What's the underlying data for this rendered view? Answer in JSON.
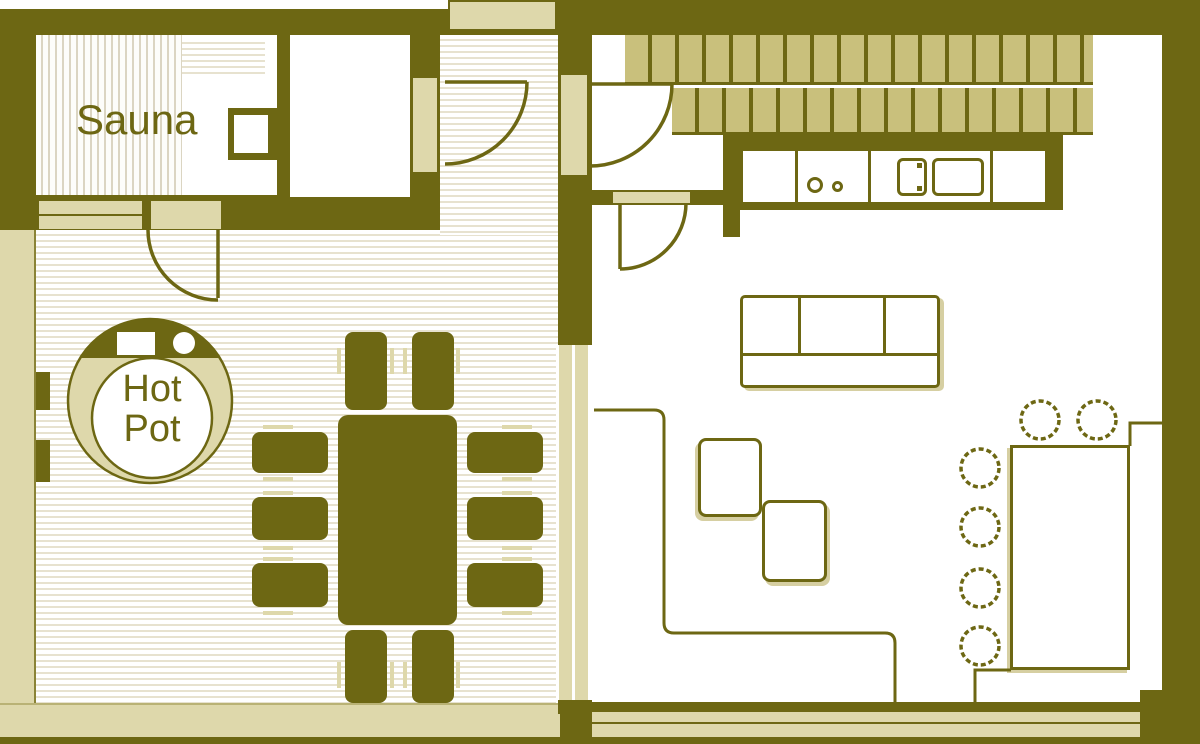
{
  "plan": {
    "title": "Cabin floor plan",
    "labels": {
      "sauna": "Sauna",
      "hot_pot_line1": "Hot",
      "hot_pot_line2": "Pot"
    },
    "colors": {
      "wall": "#6d6713",
      "tile_hatch": "#c9c07c",
      "beige_fixture": "#ded8ab",
      "floor_stripe": "#e7e2cf",
      "floor_white": "#ffffff",
      "text": "#6d6713"
    },
    "rooms": [
      {
        "name": "sauna",
        "label": "Sauna"
      },
      {
        "name": "dining-room",
        "label": ""
      },
      {
        "name": "closet",
        "label": ""
      },
      {
        "name": "entry-corridor",
        "label": ""
      },
      {
        "name": "living-kitchen",
        "label": ""
      }
    ],
    "furniture": [
      "hot-pot-tub",
      "sauna-benches",
      "sauna-stove",
      "dining-table",
      "dining-chairs-x10",
      "kitchen-counter",
      "kitchen-hob",
      "kitchen-sink",
      "sofa-three-seat",
      "side-table-1",
      "side-table-2",
      "bar-table",
      "bar-stools-x6",
      "corner-bench",
      "deck-tiles",
      "doors-x4"
    ]
  }
}
